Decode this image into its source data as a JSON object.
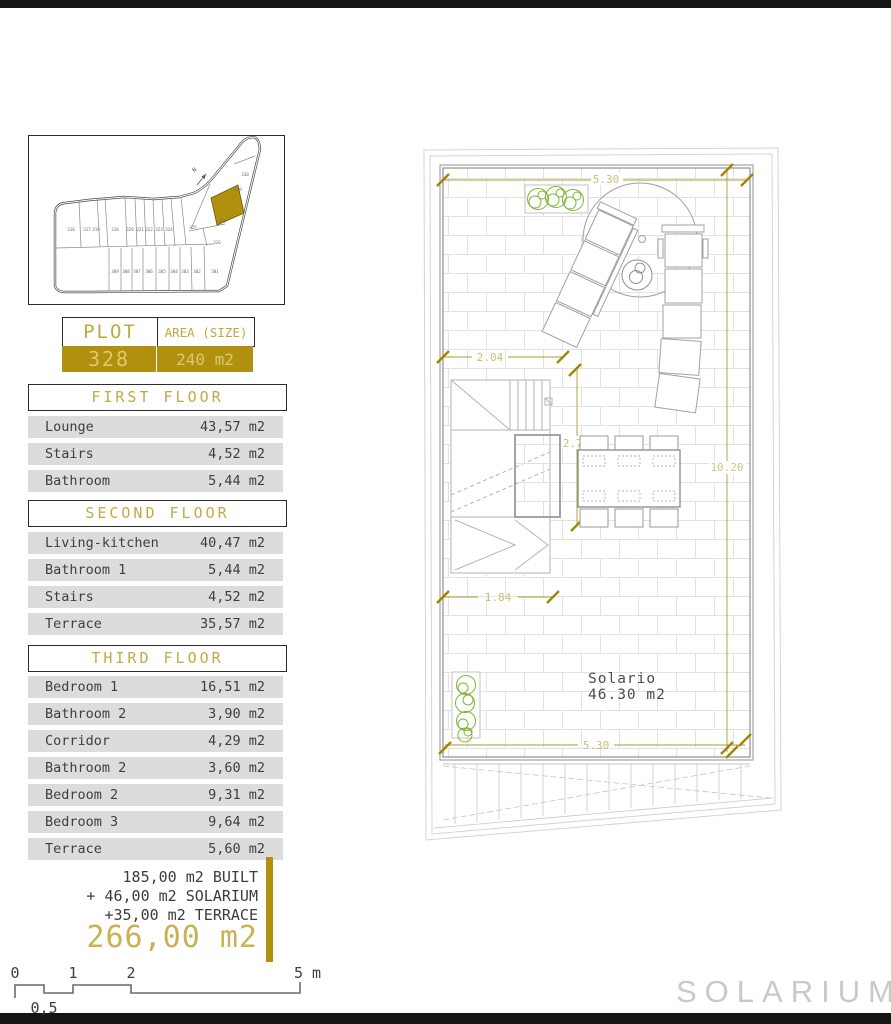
{
  "colors": {
    "gold": "#b2900f",
    "gold_header_text": "#bfa93f",
    "gold_light_text": "#dcc96d",
    "dim_line_olive": "#ab9b2e",
    "dim_label_olive": "#c9bd72",
    "row_bg": "#dcdcdc",
    "text_dark": "#3e3e3e",
    "plan_gray": "#9a9a9a",
    "plant_green": "#7db733",
    "watermark_gray": "#c9c9c9"
  },
  "site_plan": {
    "north_label": "N",
    "highlighted_plot": "328",
    "top_row_plots": [
      "316",
      "317",
      "319",
      "318",
      "320",
      "321",
      "322",
      "323",
      "324",
      "325"
    ],
    "bottom_row_plots": [
      "309",
      "308",
      "307",
      "306",
      "305",
      "304",
      "303",
      "302",
      "301"
    ],
    "tail_plots": [
      "330",
      "329",
      "327",
      "326"
    ]
  },
  "plot_table": {
    "header_plot": "PLOT",
    "header_area": "AREA (SIZE)",
    "plot": "328",
    "area": "240 m2"
  },
  "floors": [
    {
      "title": "FIRST FLOOR",
      "rows": [
        {
          "label": "Lounge",
          "value": "43,57 m2"
        },
        {
          "label": "Stairs",
          "value": "4,52 m2"
        },
        {
          "label": "Bathroom",
          "value": "5,44 m2"
        }
      ]
    },
    {
      "title": "SECOND FLOOR",
      "rows": [
        {
          "label": "Living-kitchen",
          "value": "40,47 m2"
        },
        {
          "label": "Bathroom 1",
          "value": "5,44 m2"
        },
        {
          "label": "Stairs",
          "value": "4,52 m2"
        },
        {
          "label": "Terrace",
          "value": "35,57 m2"
        }
      ]
    },
    {
      "title": "THIRD FLOOR",
      "rows": [
        {
          "label": "Bedroom 1",
          "value": "16,51 m2"
        },
        {
          "label": "Bathroom 2",
          "value": "3,90 m2"
        },
        {
          "label": "Corridor",
          "value": "4,29 m2"
        },
        {
          "label": "Bathroom 2",
          "value": "3,60 m2"
        },
        {
          "label": "Bedroom 2",
          "value": "9,31 m2"
        },
        {
          "label": "Bedroom 3",
          "value": "9,64 m2"
        },
        {
          "label": "Terrace",
          "value": "5,60 m2"
        }
      ]
    }
  ],
  "summary": {
    "line1": "185,00 m2 BUILT",
    "line2": "+ 46,00 m2 SOLARIUM",
    "line3": "+35,00 m2 TERRACE",
    "total": "266,00 m2"
  },
  "scale_bar": {
    "t0": "0",
    "t1": "1",
    "t2": "2",
    "t5": "5 m",
    "half": "0,5"
  },
  "plan": {
    "dim_top": "5.30",
    "dim_204": "2.04",
    "dim_278": "2.78",
    "dim_184": "1.84",
    "dim_1020": "10.20",
    "dim_530": "5.30",
    "room_name": "Solario",
    "room_area": "46.30 m2"
  },
  "watermark": "SOLARIUM"
}
